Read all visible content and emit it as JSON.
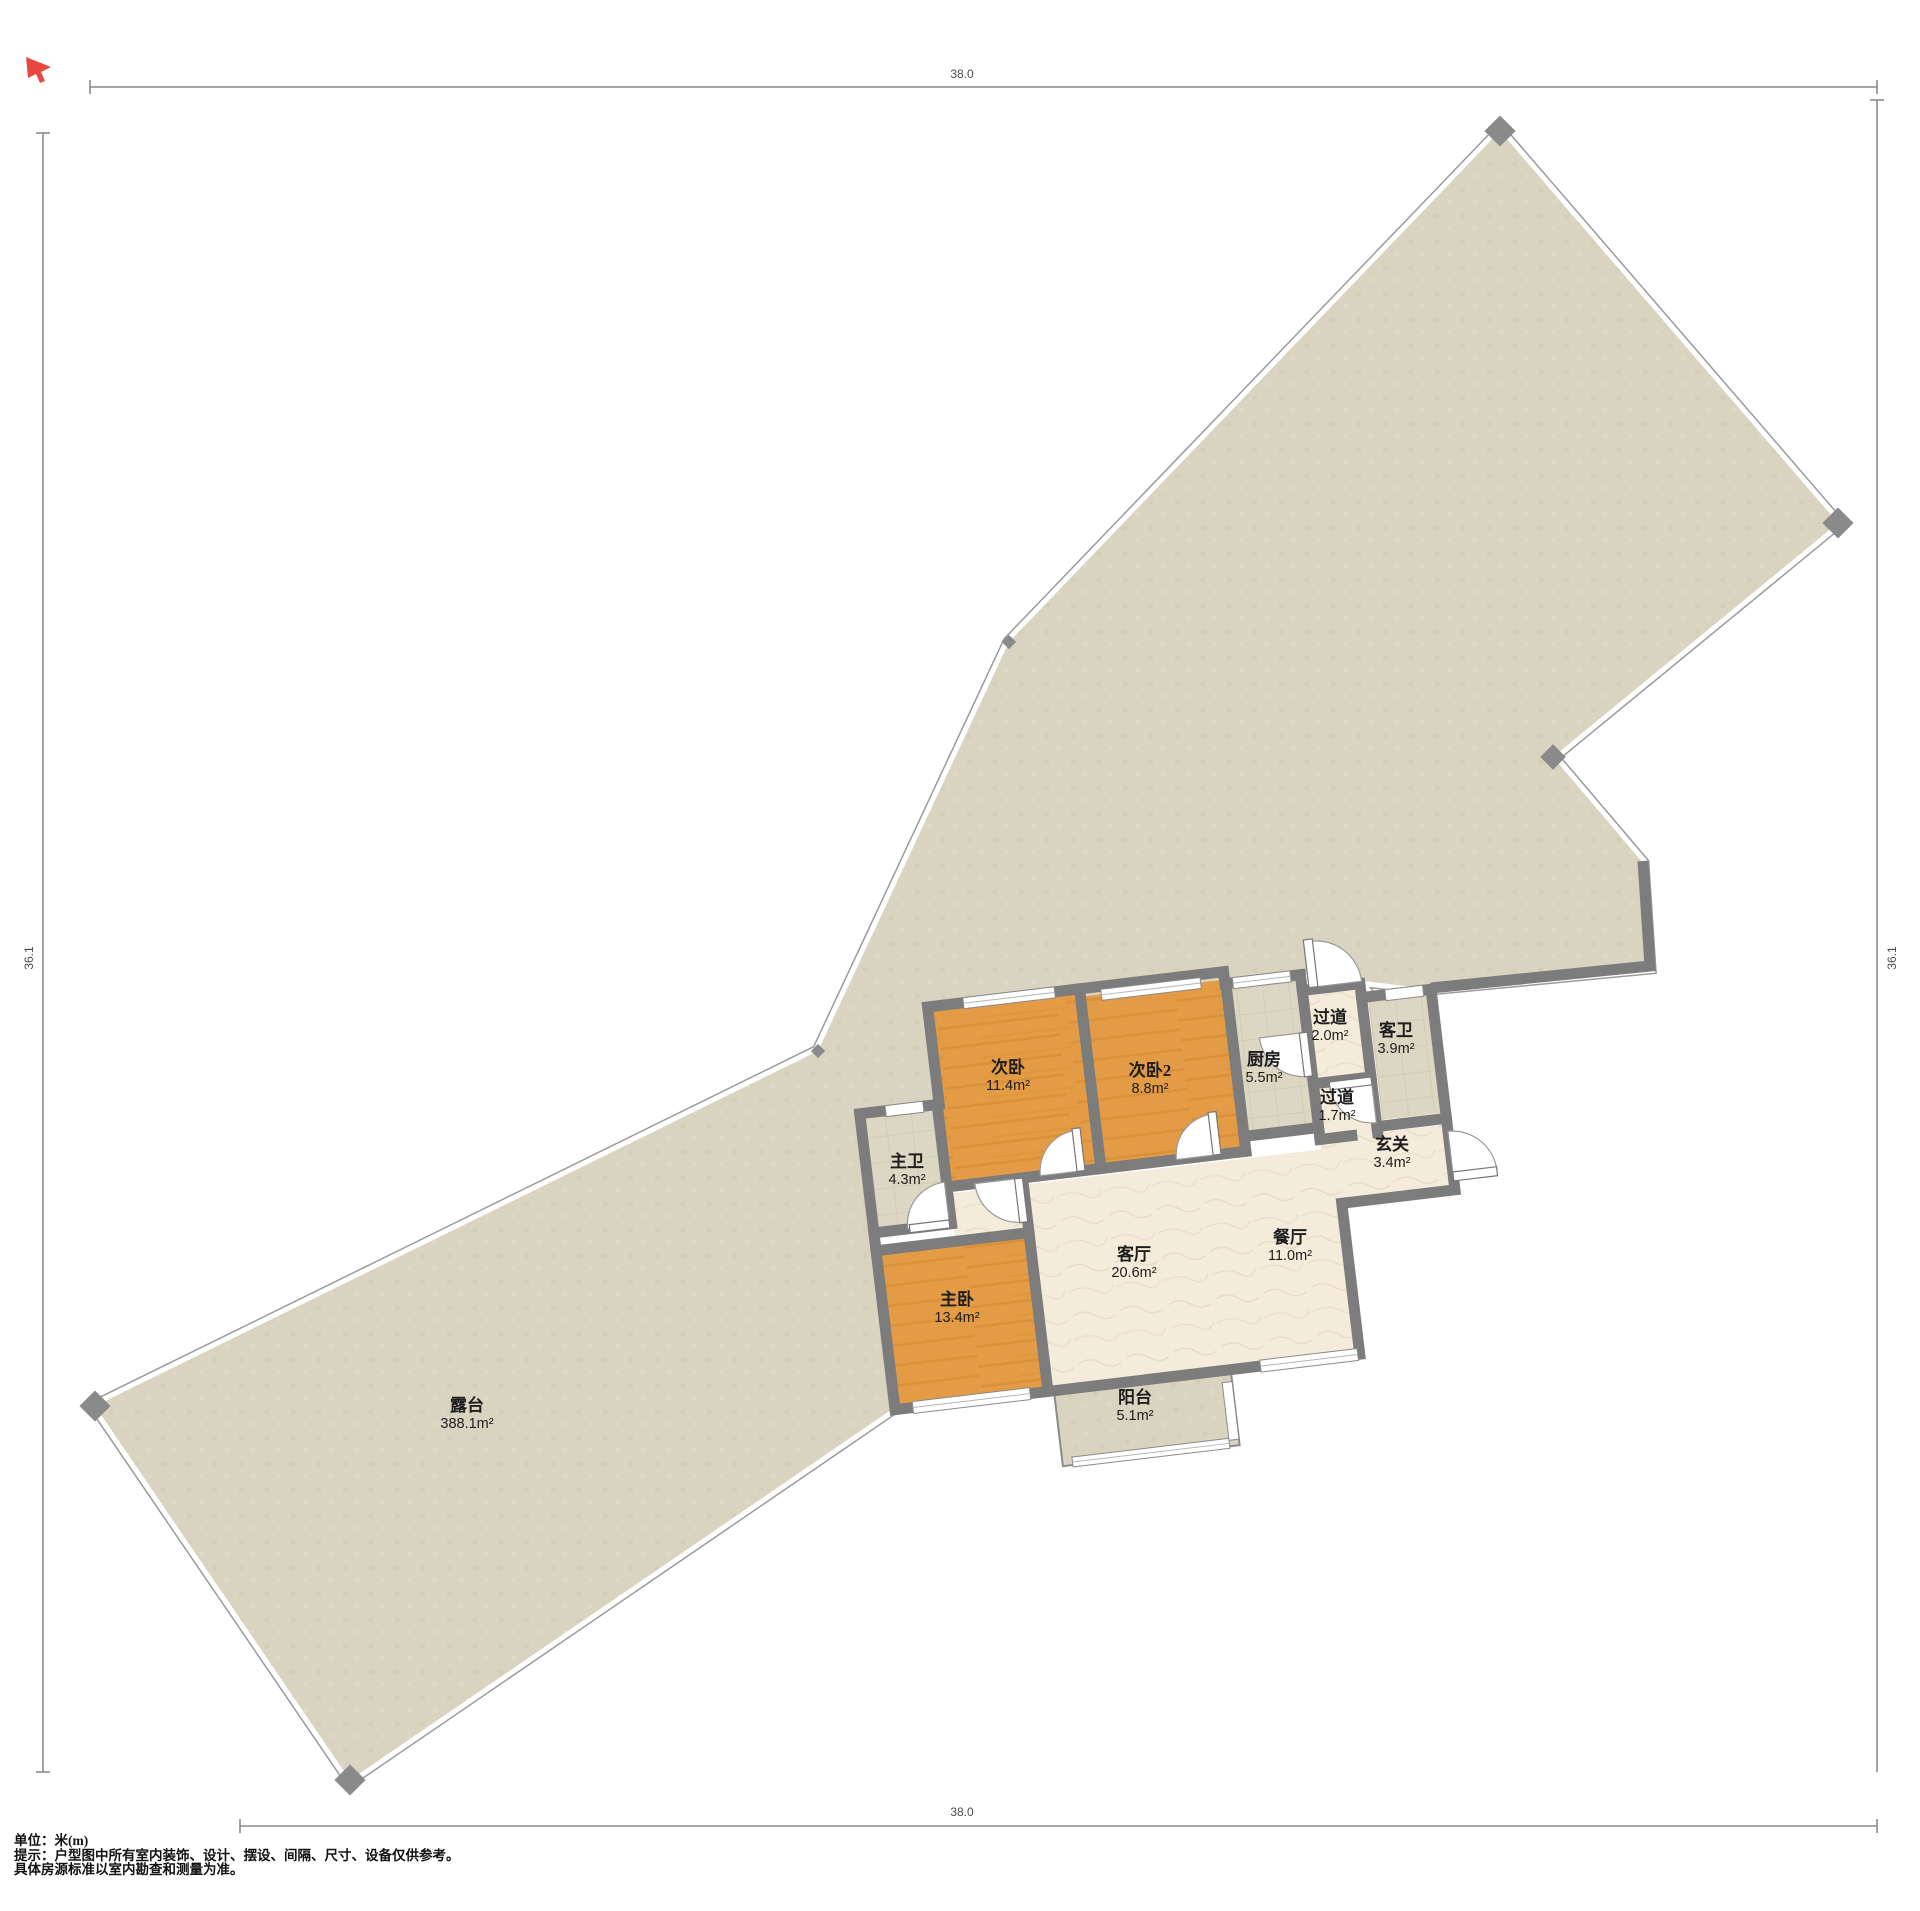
{
  "title": "户型图",
  "dimensions": {
    "top": "38.0",
    "bottom": "38.0",
    "left": "36.1",
    "right": "36.1"
  },
  "notes": {
    "unit": "单位：米(m)",
    "line1": "提示：户型图中所有室内装饰、设计、摆设、间隔、尺寸、设备仅供参考。",
    "line2": "具体房源标准以室内勘查和测量为准。"
  },
  "rooms": [
    {
      "id": "terrace",
      "name": "露台",
      "area": "388.1m²",
      "x": 467,
      "y": 1414
    },
    {
      "id": "secondary-bedroom",
      "name": "次卧",
      "area": "11.4m²",
      "x": 1008,
      "y": 1076
    },
    {
      "id": "secondary-bedroom-2",
      "name": "次卧2",
      "area": "8.8m²",
      "x": 1150,
      "y": 1079
    },
    {
      "id": "kitchen",
      "name": "厨房",
      "area": "5.5m²",
      "x": 1264,
      "y": 1068
    },
    {
      "id": "hallway-upper",
      "name": "过道",
      "area": "2.0m²",
      "x": 1330,
      "y": 1026
    },
    {
      "id": "guest-bathroom",
      "name": "客卫",
      "area": "3.9m²",
      "x": 1396,
      "y": 1039
    },
    {
      "id": "hallway-lower",
      "name": "过道",
      "area": "1.7m²",
      "x": 1337,
      "y": 1106
    },
    {
      "id": "entryway",
      "name": "玄关",
      "area": "3.4m²",
      "x": 1392,
      "y": 1153
    },
    {
      "id": "living-room",
      "name": "客厅",
      "area": "20.6m²",
      "x": 1134,
      "y": 1263
    },
    {
      "id": "dining-room",
      "name": "餐厅",
      "area": "11.0m²",
      "x": 1290,
      "y": 1246
    },
    {
      "id": "master-bedroom",
      "name": "主卧",
      "area": "13.4m²",
      "x": 957,
      "y": 1308
    },
    {
      "id": "master-bathroom",
      "name": "主卫",
      "area": "4.3m²",
      "x": 907,
      "y": 1170
    },
    {
      "id": "balcony",
      "name": "阳台",
      "area": "5.1m²",
      "x": 1135,
      "y": 1406
    }
  ],
  "colors": {
    "terrace": "#D8D4BF",
    "living_cream": "#F4EBDA",
    "bedroom_wood": "#E49B45",
    "bathroom_tile": "#DBD7C2",
    "wall": "#7C7C7C",
    "cursor_red": "#E8483F",
    "dimension_line": "#8a8a8a"
  }
}
